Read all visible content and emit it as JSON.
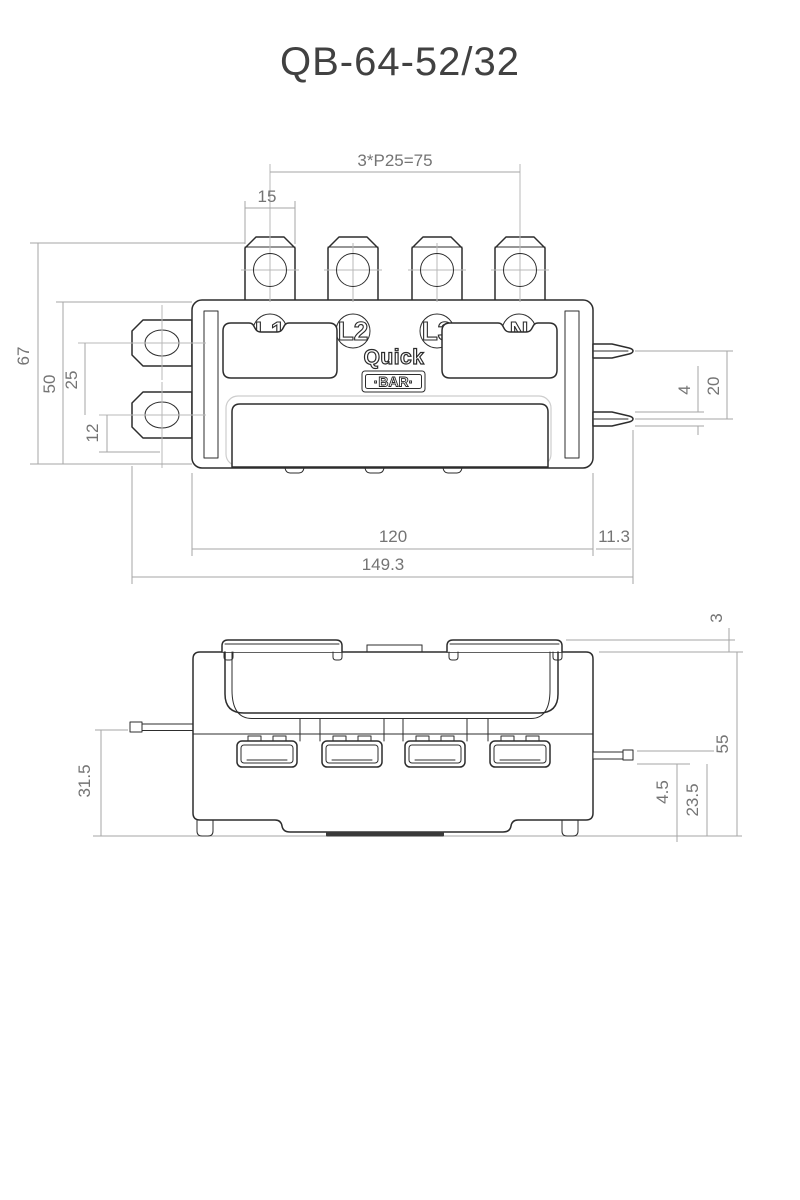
{
  "title": "QB-64-52/32",
  "brand": {
    "word1": "Quick",
    "word2": "·BAR·"
  },
  "top_view": {
    "terminal_labels": [
      "L1",
      "L2",
      "L3",
      "N"
    ],
    "dims": {
      "pitch": "3*P25=75",
      "hole_width": "15",
      "total_height": "67",
      "body_height": "50",
      "tab_pitch": "25",
      "tab_offset": "12",
      "pin_width": "4",
      "pin_pitch": "20",
      "body_length": "120",
      "pin_overhang": "11.3",
      "total_length": "149.3"
    }
  },
  "side_view": {
    "dims": {
      "cover_height": "3",
      "total_height": "55",
      "pin_height": "31.5",
      "pin_offset": "4.5",
      "pin_base_height": "23.5"
    }
  },
  "colors": {
    "part_line": "#2d2d2d",
    "dim_line": "#a6a6a6",
    "dim_text": "#747474",
    "title_text": "#414141"
  }
}
